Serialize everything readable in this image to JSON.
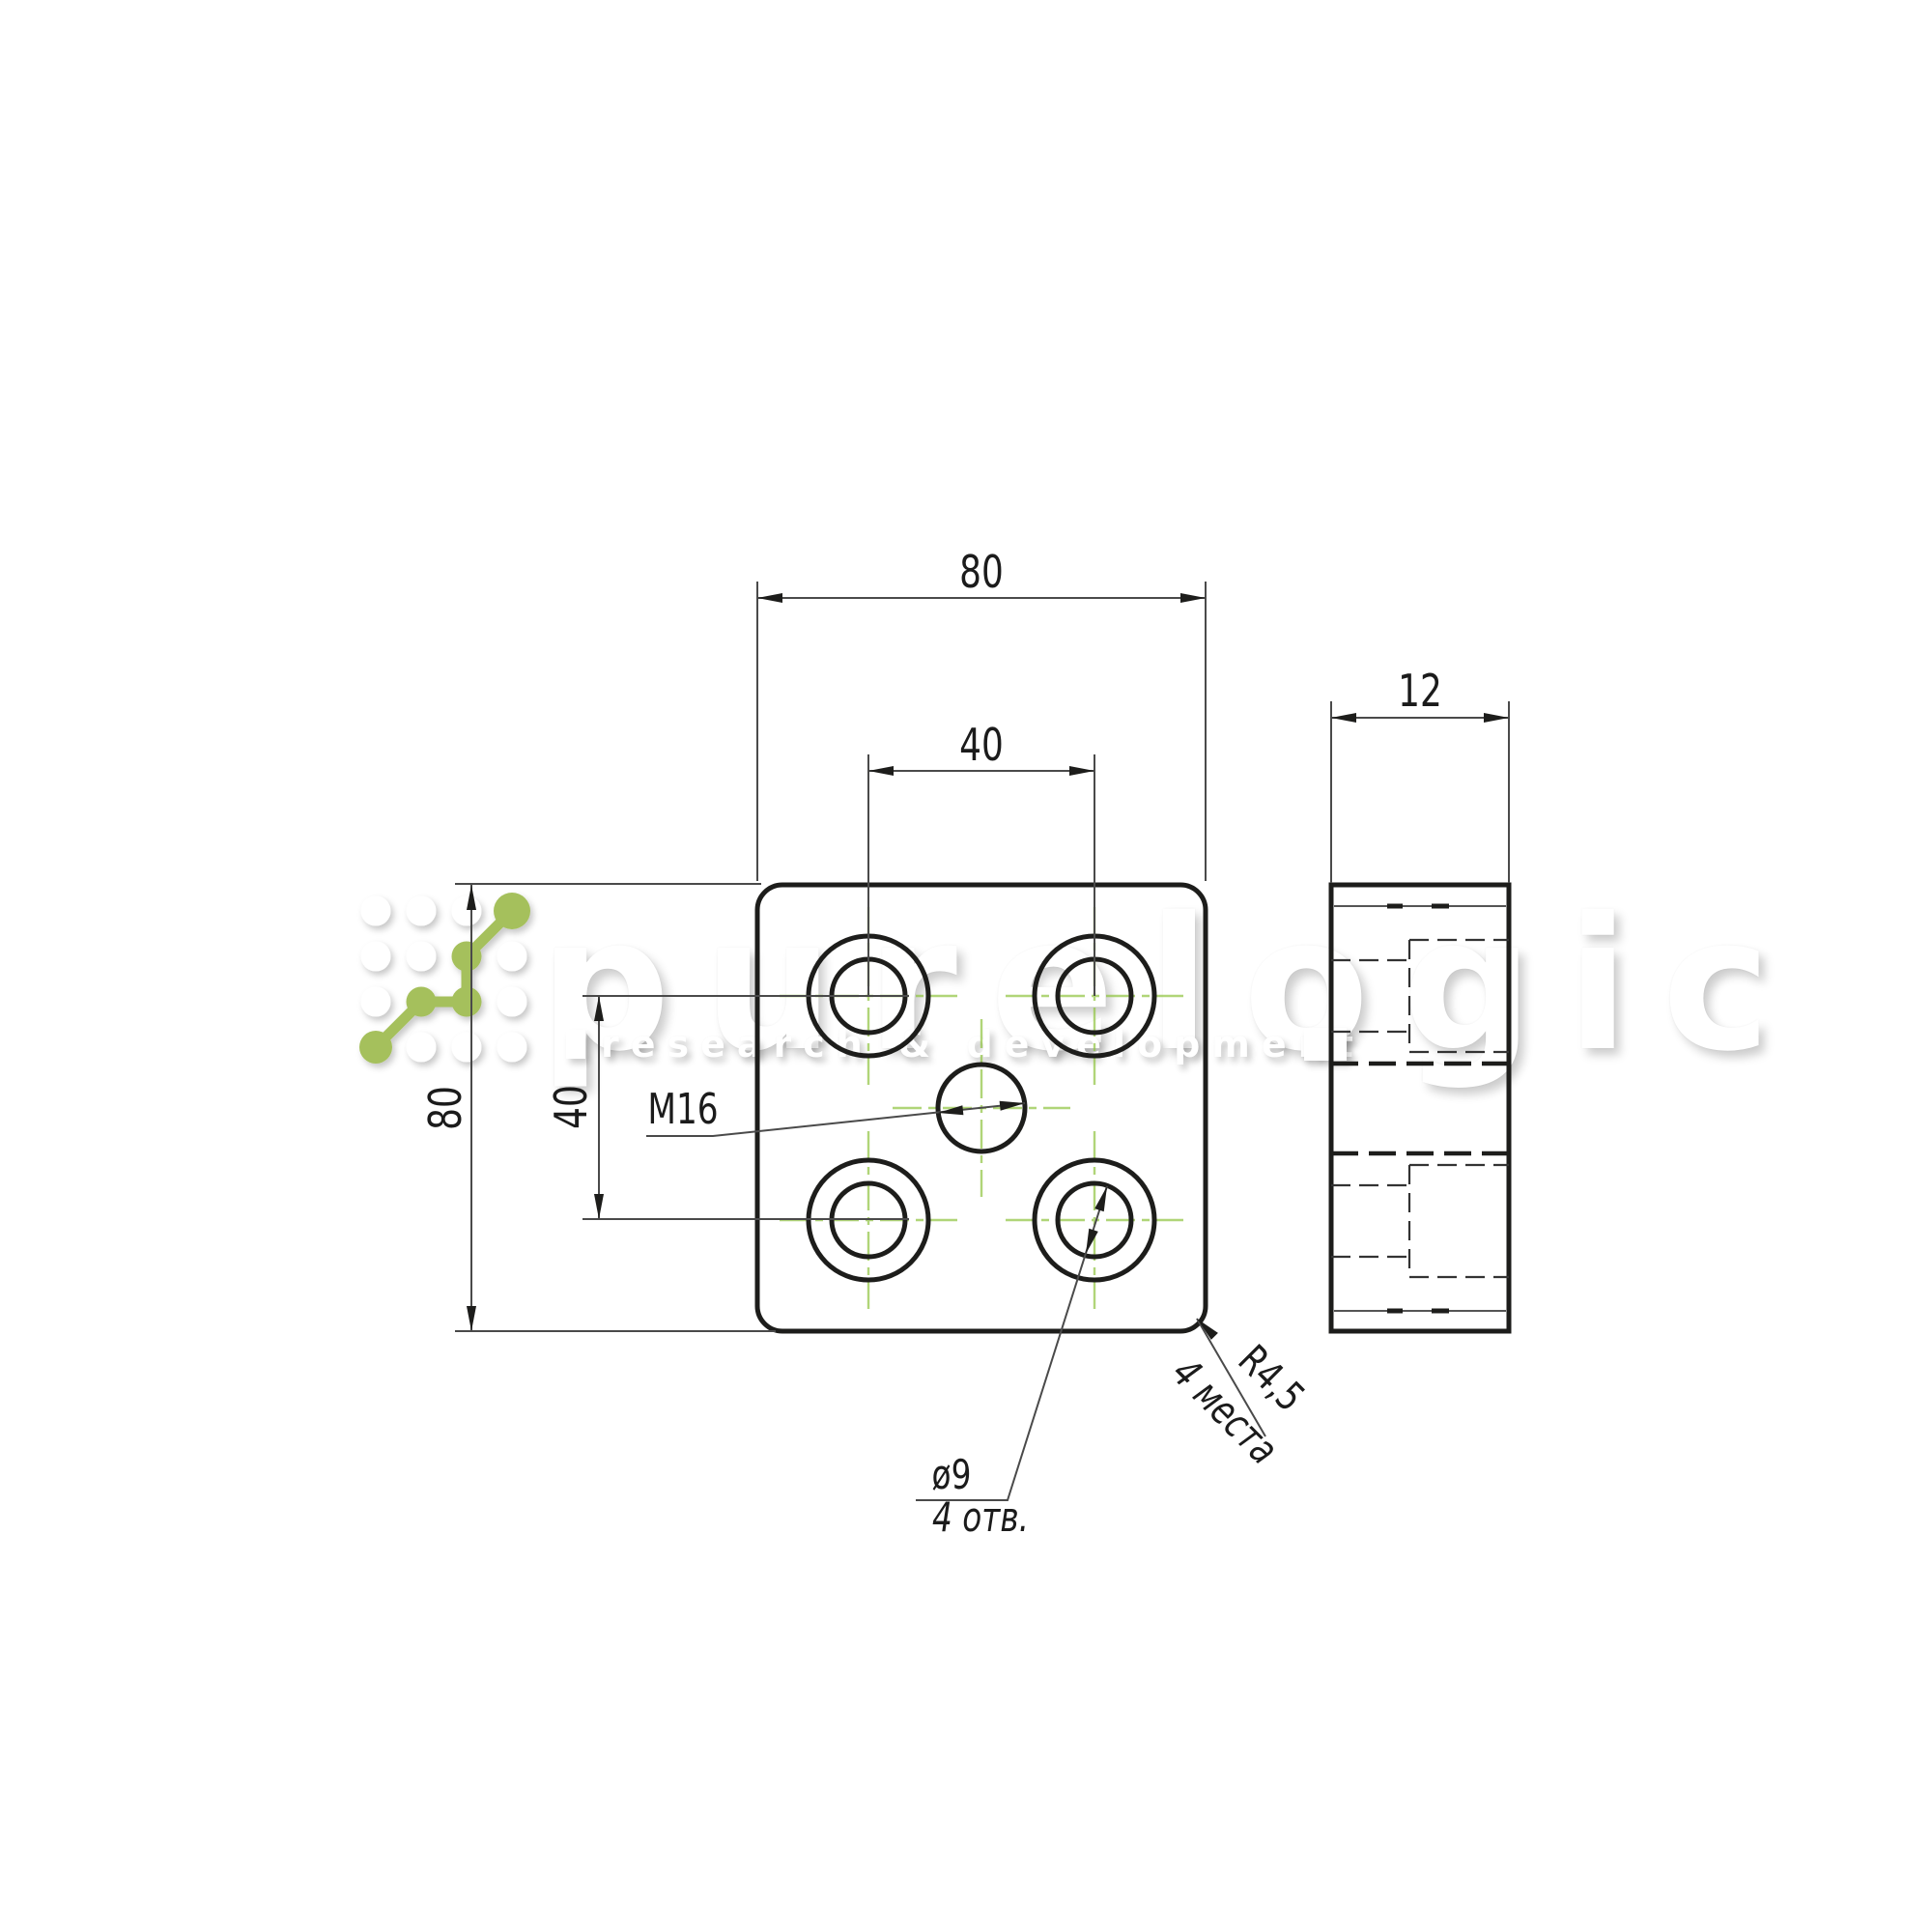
{
  "watermark": {
    "brand": "purelogic",
    "tagline": "research & development"
  },
  "front_view": {
    "dim_width": "80",
    "dim_hole_spacing_x": "40",
    "dim_height": "80",
    "dim_hole_spacing_y": "40",
    "thread_label": "M16",
    "hole_diameter": "ø9",
    "hole_count": "4 отв.",
    "corner_radius": "R4,5",
    "corner_places": "4 места"
  },
  "side_view": {
    "dim_thickness": "12"
  },
  "colors": {
    "outline": "#1d1d1b",
    "thin_line": "#4a4a4a",
    "centerline_green": "#8fc43f",
    "logo_green": "#a5c05c"
  }
}
